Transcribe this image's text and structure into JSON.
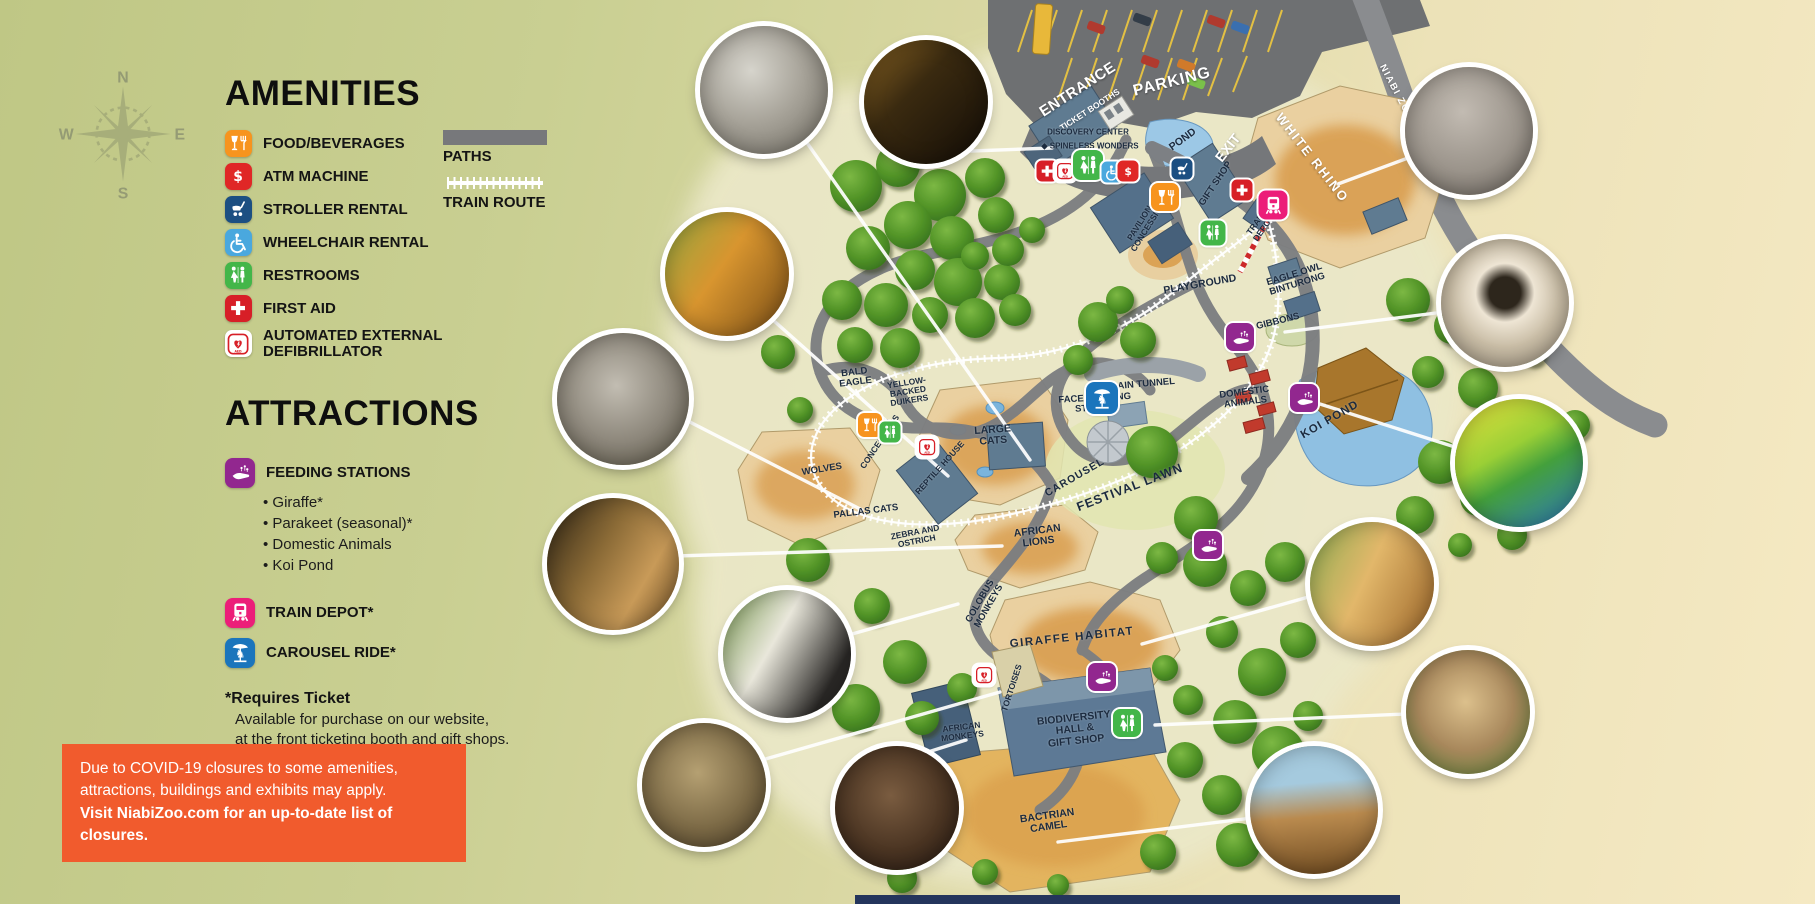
{
  "legend": {
    "amenities_title": "AMENITIES",
    "amenities": [
      {
        "label": "FOOD/BEVERAGES",
        "icon": "food"
      },
      {
        "label": "ATM MACHINE",
        "icon": "atm"
      },
      {
        "label": "STROLLER RENTAL",
        "icon": "stroller"
      },
      {
        "label": "WHEELCHAIR RENTAL",
        "icon": "wheelchair"
      },
      {
        "label": "RESTROOMS",
        "icon": "restroom"
      },
      {
        "label": "FIRST AID",
        "icon": "firstaid"
      },
      {
        "label": "AUTOMATED EXTERNAL\nDEFIBRILLATOR",
        "icon": "aed"
      }
    ],
    "paths_label": "PATHS",
    "train_route_label": "TRAIN ROUTE",
    "attractions_title": "ATTRACTIONS",
    "attractions": [
      {
        "label": "FEEDING STATIONS",
        "icon": "feeding",
        "bullets": [
          "Giraffe*",
          "Parakeet (seasonal)*",
          "Domestic Animals",
          "Koi Pond"
        ]
      },
      {
        "label": "TRAIN DEPOT*",
        "icon": "train"
      },
      {
        "label": "CAROUSEL RIDE*",
        "icon": "carousel"
      }
    ],
    "ticket_note_title": "*Requires Ticket",
    "ticket_note_lines": [
      "Available for purchase on our website,",
      "at the front ticketing booth and gift shops."
    ]
  },
  "notice": {
    "lines": [
      "Due to COVID-19 closures to some amenities,",
      "attractions, buildings and exhibits may apply."
    ],
    "bold_line": "Visit NiabiZoo.com for an up-to-date list of closures."
  },
  "compass": {
    "n": "N",
    "e": "E",
    "s": "S",
    "w": "W"
  },
  "icon_colors": {
    "food": "#f7941e",
    "atm": "#e02726",
    "stroller": "#1c4f82",
    "wheelchair": "#4aa8de",
    "restroom": "#43b649",
    "firstaid": "#d71f27",
    "aed": "#ffffff",
    "feeding": "#92278f",
    "train": "#ec1e79",
    "carousel": "#1b75bc"
  },
  "colors": {
    "notice_background": "#f15b2d",
    "path_gray": "#77787b",
    "habitat_tan": "#ead0a0",
    "water_blue": "#8fc0e2"
  },
  "map": {
    "labels": [
      {
        "text": "ENTRANCE"
      },
      {
        "text": "TICKET BOOTHS"
      },
      {
        "text": "PARKING"
      },
      {
        "text": "EXIT"
      },
      {
        "text": "NIABI ZOO ROAD"
      },
      {
        "text": "WHITE RHINO"
      },
      {
        "text": "POND"
      },
      {
        "text": "GIFT SHOP"
      },
      {
        "text": "DISCOVERY CENTER"
      },
      {
        "text": "◆ SPINELESS WONDERS"
      },
      {
        "text": "PAVILION &\nCONCESSIONS"
      },
      {
        "text": "TRAIN\nDEPOT"
      },
      {
        "text": "PLAYGROUND"
      },
      {
        "text": "EAGLE OWL\nBINTURONG"
      },
      {
        "text": "GIBBONS"
      },
      {
        "text": "TRAIN TUNNEL"
      },
      {
        "text": "FACE PAINTING\nSTATION"
      },
      {
        "text": "DOMESTIC\nANIMALS"
      },
      {
        "text": "KOI POND"
      },
      {
        "text": "BALD\nEAGLE"
      },
      {
        "text": "YELLOW-\nBACKED\nDUIKERS"
      },
      {
        "text": "CONCESSIONS"
      },
      {
        "text": "REPTILE HOUSE"
      },
      {
        "text": "LARGE\nCATS"
      },
      {
        "text": "WOLVES"
      },
      {
        "text": "PALLAS CATS"
      },
      {
        "text": "ZEBRA AND\nOSTRICH"
      },
      {
        "text": "AFRICAN\nLIONS"
      },
      {
        "text": "CAROUSEL"
      },
      {
        "text": "FESTIVAL LAWN"
      },
      {
        "text": "COLOBUS\nMONKEYS"
      },
      {
        "text": "GIRAFFE HABITAT"
      },
      {
        "text": "TORTOISES"
      },
      {
        "text": "AFRICAN\nMONKEYS"
      },
      {
        "text": "BIODIVERSITY\nHALL &\nGIFT SHOP"
      },
      {
        "text": "BACTRIAN\nCAMEL"
      }
    ]
  }
}
